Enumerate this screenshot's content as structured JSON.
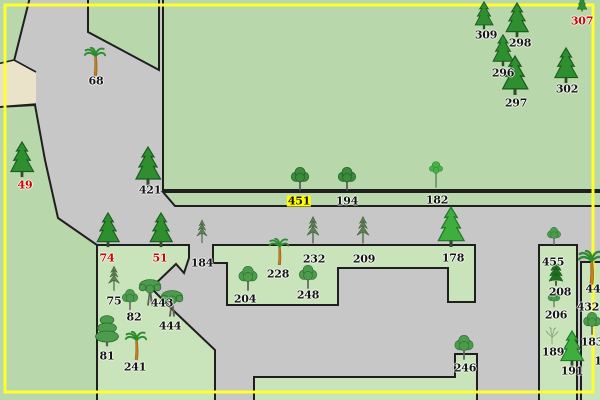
{
  "map": {
    "description": "tree-inventory-map",
    "colors": {
      "road": "#c7c7c7",
      "field_green": "#b8d7aa",
      "parcel_green": "#c9e4ba",
      "beige": "#eae3c9",
      "line": "#1f1f1f",
      "border_yellow": "#ffff2e",
      "label_black": "#141414",
      "label_red": "#cf0000",
      "label_highlight_bg": "#ffff00"
    },
    "trees": [
      {
        "label": "68",
        "type": "palm",
        "x": 95,
        "y": 77,
        "h": 30,
        "lx": 96,
        "ly": 81
      },
      {
        "label": "49",
        "type": "fir",
        "x": 22,
        "y": 178,
        "h": 37,
        "lx": 25,
        "ly": 185,
        "red": true
      },
      {
        "label": "421",
        "type": "fir",
        "x": 148,
        "y": 186,
        "h": 40,
        "lx": 150,
        "ly": 190
      },
      {
        "label": "307",
        "type": "fir",
        "x": 582,
        "y": 12,
        "h": 16,
        "lx": 582,
        "ly": 21,
        "red": true
      },
      {
        "label": "309",
        "type": "fir",
        "x": 484,
        "y": 30,
        "h": 29,
        "lx": 486,
        "ly": 35
      },
      {
        "label": "298",
        "type": "fir",
        "x": 517,
        "y": 38,
        "h": 36,
        "lx": 520,
        "ly": 43
      },
      {
        "label": "296",
        "type": "fir",
        "x": 503,
        "y": 67,
        "h": 33,
        "lx": 503,
        "ly": 73
      },
      {
        "label": "297",
        "type": "fir",
        "x": 515,
        "y": 96,
        "h": 41,
        "lx": 516,
        "ly": 103
      },
      {
        "label": "302",
        "type": "fir",
        "x": 566,
        "y": 84,
        "h": 37,
        "lx": 567,
        "ly": 89
      },
      {
        "label": "451",
        "type": "deciduous_dark",
        "x": 300,
        "y": 192,
        "h": 25,
        "lx": 299,
        "ly": 201,
        "highlight": true
      },
      {
        "label": "194",
        "type": "deciduous_dark",
        "x": 347,
        "y": 192,
        "h": 25,
        "lx": 347,
        "ly": 201
      },
      {
        "label": "182",
        "type": "tall_thin",
        "x": 436,
        "y": 192,
        "h": 34,
        "lx": 437,
        "ly": 200
      },
      {
        "label": "74",
        "type": "fir",
        "x": 108,
        "y": 248,
        "h": 36,
        "lx": 107,
        "ly": 258,
        "red": true
      },
      {
        "label": "51",
        "type": "fir",
        "x": 161,
        "y": 248,
        "h": 36,
        "lx": 160,
        "ly": 258,
        "red": true
      },
      {
        "label": "184",
        "type": "thin_pine",
        "x": 202,
        "y": 247,
        "h": 31,
        "lx": 202,
        "ly": 263
      },
      {
        "label": "232",
        "type": "thin_pine",
        "x": 313,
        "y": 248,
        "h": 36,
        "lx": 314,
        "ly": 259
      },
      {
        "label": "209",
        "type": "thin_pine",
        "x": 363,
        "y": 248,
        "h": 36,
        "lx": 364,
        "ly": 259
      },
      {
        "label": "178",
        "type": "bright_fir",
        "x": 451,
        "y": 248,
        "h": 42,
        "lx": 453,
        "ly": 258
      },
      {
        "label": "228",
        "type": "palm",
        "x": 279,
        "y": 266,
        "h": 28,
        "lx": 278,
        "ly": 274
      },
      {
        "label": "204",
        "type": "deciduous",
        "x": 248,
        "y": 292,
        "h": 26,
        "lx": 245,
        "ly": 299
      },
      {
        "label": "248",
        "type": "deciduous",
        "x": 308,
        "y": 290,
        "h": 25,
        "lx": 308,
        "ly": 295
      },
      {
        "label": "75",
        "type": "thin_pine",
        "x": 114,
        "y": 295,
        "h": 33,
        "lx": 114,
        "ly": 301
      },
      {
        "label": "82",
        "type": "deciduous",
        "x": 130,
        "y": 311,
        "h": 22,
        "lx": 134,
        "ly": 317
      },
      {
        "label": "443",
        "type": "deciduous_wide",
        "x": 150,
        "y": 307,
        "h": 30,
        "lx": 162,
        "ly": 303
      },
      {
        "label": "444",
        "type": "deciduous_wide",
        "x": 172,
        "y": 318,
        "h": 30,
        "lx": 170,
        "ly": 326
      },
      {
        "label": "81",
        "type": "tiered",
        "x": 107,
        "y": 348,
        "h": 34,
        "lx": 107,
        "ly": 356
      },
      {
        "label": "241",
        "type": "palm",
        "x": 136,
        "y": 361,
        "h": 30,
        "lx": 135,
        "ly": 367
      },
      {
        "label": "246",
        "type": "deciduous",
        "x": 464,
        "y": 361,
        "h": 26,
        "lx": 465,
        "ly": 368
      },
      {
        "label": "455",
        "type": "deciduous",
        "x": 554,
        "y": 246,
        "h": 19,
        "lx": 553,
        "ly": 262
      },
      {
        "label": "208",
        "type": "dark_layer",
        "x": 556,
        "y": 287,
        "h": 24,
        "lx": 560,
        "ly": 292
      },
      {
        "label": "206",
        "type": "deciduous",
        "x": 554,
        "y": 308,
        "h": 17,
        "lx": 556,
        "ly": 315
      },
      {
        "label": "189",
        "type": "bare",
        "x": 552,
        "y": 345,
        "h": 20,
        "lx": 553,
        "ly": 352
      },
      {
        "label": "191",
        "type": "bright_fir",
        "x": 572,
        "y": 367,
        "h": 37,
        "lx": 572,
        "ly": 371
      },
      {
        "label": "44",
        "type": "palm",
        "x": 591,
        "y": 286,
        "h": 36,
        "lx": 593,
        "ly": 289
      },
      {
        "label": "432",
        "type": "none",
        "x": 588,
        "y": 305,
        "h": 0,
        "lx": 588,
        "ly": 307
      },
      {
        "label": "183",
        "type": "deciduous",
        "x": 592,
        "y": 336,
        "h": 24,
        "lx": 592,
        "ly": 342
      },
      {
        "label": "1",
        "type": "none",
        "x": 597,
        "y": 360,
        "h": 0,
        "lx": 598,
        "ly": 361
      }
    ]
  }
}
